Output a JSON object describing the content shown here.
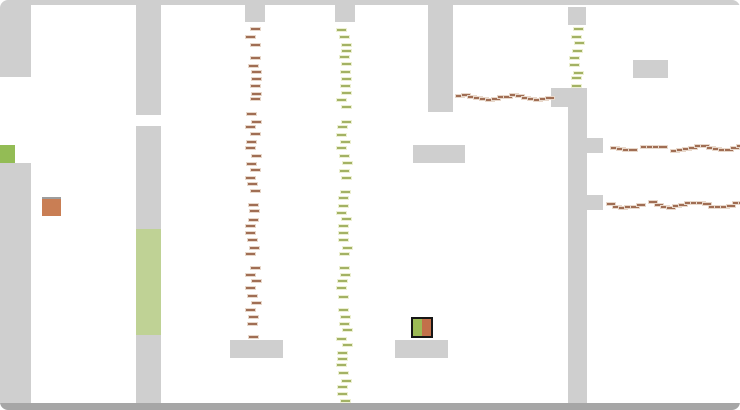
{
  "canvas": {
    "width": 740,
    "height": 410,
    "background": "#ffffff"
  },
  "colors": {
    "wall": "#cfcfcf",
    "border_bar": "#a6a6a6",
    "door_green": "#bfd295",
    "marker_green": "#93bc55",
    "marker_orange": "#c97e54",
    "marker_orange_edge": "#9d9d9d",
    "trail_brown_core": "#a06e54",
    "trail_brown_halo": "#e8d8cb",
    "trail_green_core": "#a3b264",
    "trail_green_halo": "#edf0d2",
    "player_border": "#161616",
    "player_left": "#9cba55",
    "player_right": "#c2704a"
  },
  "blocks": [
    {
      "name": "top-border",
      "x": 0,
      "y": 0,
      "w": 740,
      "h": 5,
      "color": "wall"
    },
    {
      "name": "wall-left-upper",
      "x": 0,
      "y": 5,
      "w": 31,
      "h": 72,
      "color": "wall"
    },
    {
      "name": "wall-left-lower",
      "x": 0,
      "y": 163,
      "w": 31,
      "h": 241,
      "color": "wall"
    },
    {
      "name": "wall-col2-top",
      "x": 136,
      "y": 5,
      "w": 25,
      "h": 110,
      "color": "wall"
    },
    {
      "name": "wall-col2-mid",
      "x": 136,
      "y": 126,
      "w": 25,
      "h": 103,
      "color": "wall"
    },
    {
      "name": "door-green",
      "x": 136,
      "y": 229,
      "w": 25,
      "h": 106,
      "color": "door_green"
    },
    {
      "name": "wall-col2-bottom",
      "x": 136,
      "y": 335,
      "w": 25,
      "h": 69,
      "color": "wall"
    },
    {
      "name": "wall-stub-a",
      "x": 245,
      "y": 5,
      "w": 20,
      "h": 17,
      "color": "wall"
    },
    {
      "name": "wall-stub-b",
      "x": 335,
      "y": 5,
      "w": 20,
      "h": 17,
      "color": "wall"
    },
    {
      "name": "wall-col3",
      "x": 428,
      "y": 5,
      "w": 25,
      "h": 107,
      "color": "wall"
    },
    {
      "name": "wall-stub-c",
      "x": 568,
      "y": 7,
      "w": 18,
      "h": 18,
      "color": "wall"
    },
    {
      "name": "platform-mid",
      "x": 413,
      "y": 145,
      "w": 52,
      "h": 18,
      "color": "wall"
    },
    {
      "name": "platform-top-right",
      "x": 633,
      "y": 60,
      "w": 35,
      "h": 18,
      "color": "wall"
    },
    {
      "name": "wall-rcol-ledge",
      "x": 551,
      "y": 88,
      "w": 36,
      "h": 19,
      "color": "wall"
    },
    {
      "name": "wall-rcol-main",
      "x": 568,
      "y": 88,
      "w": 19,
      "h": 316,
      "color": "wall"
    },
    {
      "name": "wall-rcol-tab1",
      "x": 587,
      "y": 138,
      "w": 16,
      "h": 15,
      "color": "wall"
    },
    {
      "name": "wall-rcol-tab2",
      "x": 587,
      "y": 195,
      "w": 16,
      "h": 15,
      "color": "wall"
    },
    {
      "name": "platform-bottom-left",
      "x": 230,
      "y": 340,
      "w": 53,
      "h": 18,
      "color": "wall"
    },
    {
      "name": "platform-bottom-right",
      "x": 395,
      "y": 340,
      "w": 53,
      "h": 18,
      "color": "wall"
    },
    {
      "name": "bottom-border",
      "x": 0,
      "y": 403,
      "w": 740,
      "h": 7,
      "color": "border_bar"
    }
  ],
  "markers": [
    {
      "name": "green-marker",
      "x": 0,
      "y": 145,
      "w": 15,
      "h": 18,
      "color": "marker_green",
      "top_edge": false
    },
    {
      "name": "orange-marker",
      "x": 42,
      "y": 197,
      "w": 19,
      "h": 19,
      "color": "marker_orange",
      "top_edge": true
    }
  ],
  "player": {
    "x": 411,
    "y": 317,
    "w": 22,
    "h": 21
  },
  "trails": [
    {
      "name": "trail-brown-vertical",
      "dir": "v",
      "x": 253,
      "y": 28,
      "len": 310,
      "step": 7,
      "palette": "brown",
      "seed": 1
    },
    {
      "name": "trail-green-vertical-long",
      "dir": "v",
      "x": 344,
      "y": 28,
      "len": 374,
      "step": 7,
      "palette": "green",
      "seed": 2
    },
    {
      "name": "trail-green-vertical-short",
      "dir": "v",
      "x": 577,
      "y": 28,
      "len": 58,
      "step": 7,
      "palette": "green",
      "seed": 3
    },
    {
      "name": "trail-brown-horizontal-top",
      "dir": "h",
      "x": 455,
      "y": 96,
      "len": 95,
      "step": 6,
      "palette": "brown",
      "seed": 4
    },
    {
      "name": "trail-brown-horizontal-right1",
      "dir": "h",
      "x": 604,
      "y": 146,
      "len": 133,
      "step": 6,
      "palette": "brown",
      "seed": 5
    },
    {
      "name": "trail-brown-horizontal-right2",
      "dir": "h",
      "x": 606,
      "y": 203,
      "len": 132,
      "step": 6,
      "palette": "brown",
      "seed": 6
    }
  ]
}
